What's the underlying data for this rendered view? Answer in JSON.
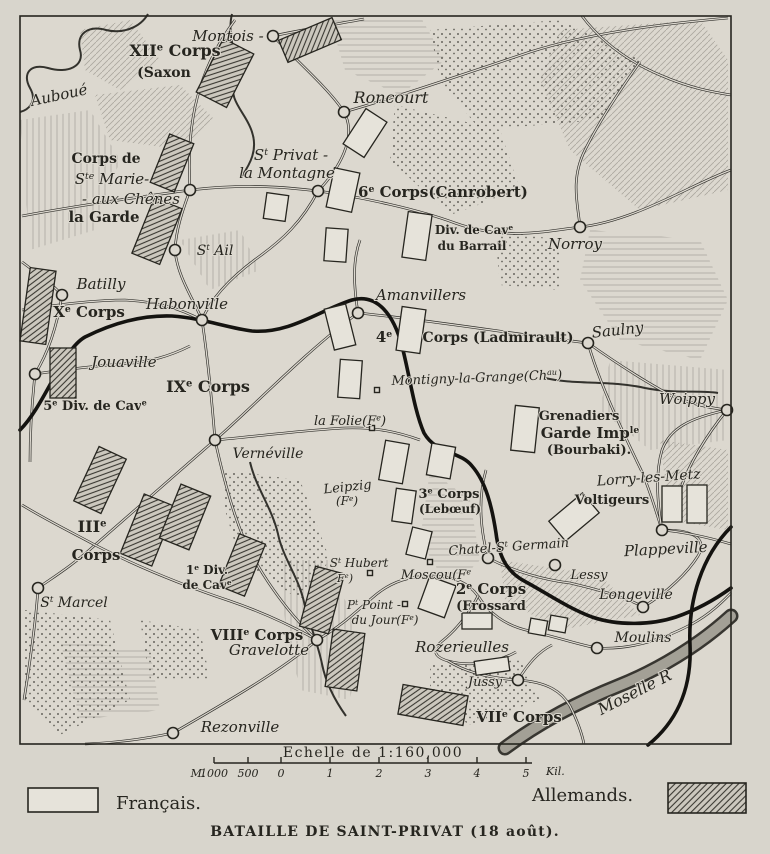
{
  "title": "Carte de la bataille de Saint-Privat",
  "colors": {
    "paper": "#d8d5cc",
    "map_fill": "#dcd8cf",
    "ink": "#26251f",
    "hatch_fill": "#ccc8be",
    "unit_french_fill": "#e6e3da"
  },
  "legend": {
    "francais": "Français.",
    "allemands": "Allemands."
  },
  "caption": "BATAILLE DE SAINT-PRIVAT (18 août).",
  "scale": {
    "title": "Echelle de 1:160,000",
    "unit_prefix": "M.",
    "unit_suffix": "Kil.",
    "bar": {
      "x1": 214,
      "x2": 526,
      "y": 763
    },
    "ticks": [
      {
        "x": 214,
        "label": "1000"
      },
      {
        "x": 248,
        "label": "500"
      },
      {
        "x": 281,
        "label": "0"
      },
      {
        "x": 330,
        "label": "1"
      },
      {
        "x": 379,
        "label": "2"
      },
      {
        "x": 428,
        "label": "3"
      },
      {
        "x": 477,
        "label": "4"
      },
      {
        "x": 526,
        "label": "5"
      }
    ]
  },
  "map": {
    "frame": {
      "x": 20,
      "y": 16,
      "w": 711,
      "h": 728
    },
    "labels": [
      {
        "id": "xii-corps",
        "t": "XII|e| Corps",
        "x": 175,
        "y": 56,
        "s": 16
      },
      {
        "id": "saxon",
        "t": "(Saxon",
        "x": 164,
        "y": 77,
        "s": 14
      },
      {
        "id": "montois",
        "t": "Montois -",
        "x": 228,
        "y": 41,
        "s": 15,
        "it": 1
      },
      {
        "id": "auboue",
        "t": "Auboué",
        "x": 60,
        "y": 100,
        "s": 15,
        "it": 1,
        "r": -12
      },
      {
        "id": "roncourt",
        "t": "Roncourt",
        "x": 391,
        "y": 103,
        "s": 16,
        "it": 1
      },
      {
        "id": "corps-de",
        "t": "Corps de",
        "x": 106,
        "y": 163,
        "s": 14
      },
      {
        "id": "ste-marie",
        "t": "S|te| Marie-",
        "x": 112,
        "y": 184,
        "s": 15,
        "it": 1
      },
      {
        "id": "aux-chenes",
        "t": "- aux Chênes",
        "x": 131,
        "y": 204,
        "s": 15,
        "it": 1
      },
      {
        "id": "la-garde",
        "t": "la Garde",
        "x": 104,
        "y": 222,
        "s": 15
      },
      {
        "id": "st-privat",
        "t": "S|t| Privat -",
        "x": 291,
        "y": 160,
        "s": 15,
        "it": 1
      },
      {
        "id": "la-montagne",
        "t": "la Montagne",
        "x": 287,
        "y": 178,
        "s": 15,
        "it": 1
      },
      {
        "id": "sixth-corps",
        "t": "6|e| Corps(Canrobert)",
        "x": 358,
        "y": 197,
        "s": 15,
        "a": "start"
      },
      {
        "id": "st-ail",
        "t": "S|t| Ail",
        "x": 215,
        "y": 255,
        "s": 14,
        "it": 1
      },
      {
        "id": "div-cav-barrail",
        "t": "Div. de Cav|e|",
        "x": 474,
        "y": 234,
        "s": 12
      },
      {
        "id": "du-barrail",
        "t": "du Barrail",
        "x": 472,
        "y": 250,
        "s": 12
      },
      {
        "id": "norroy",
        "t": "Norroy",
        "x": 575,
        "y": 249,
        "s": 15,
        "it": 1
      },
      {
        "id": "batilly",
        "t": "Batilly",
        "x": 101,
        "y": 289,
        "s": 15,
        "it": 1
      },
      {
        "id": "xe-corps",
        "t": "X|e| Corps",
        "x": 89,
        "y": 317,
        "s": 15
      },
      {
        "id": "habonville",
        "t": "Habonville",
        "x": 187,
        "y": 309,
        "s": 15,
        "it": 1
      },
      {
        "id": "jouaville",
        "t": "Jouaville",
        "x": 124,
        "y": 367,
        "s": 15,
        "it": 1
      },
      {
        "id": "amanvillers",
        "t": "Amanvillers",
        "x": 421,
        "y": 300,
        "s": 15,
        "it": 1
      },
      {
        "id": "fourth-corps-num",
        "t": "4|e|",
        "x": 384,
        "y": 342,
        "s": 15
      },
      {
        "id": "fourth-corps-name",
        "t": "Corps (Ladmirault)",
        "x": 498,
        "y": 342,
        "s": 14
      },
      {
        "id": "ixe-corps",
        "t": "IX|e| Corps",
        "x": 208,
        "y": 392,
        "s": 16
      },
      {
        "id": "fifth-div-cav",
        "t": "5|e| Div. de Cav|e|",
        "x": 95,
        "y": 410,
        "s": 13
      },
      {
        "id": "saulny",
        "t": "Saulny",
        "x": 618,
        "y": 335,
        "s": 15,
        "it": 1,
        "r": -6
      },
      {
        "id": "montigny",
        "t": "Montigny-la-Grange(Ch|au|)",
        "x": 477,
        "y": 382,
        "s": 13,
        "it": 1,
        "r": -2
      },
      {
        "id": "woippy",
        "t": "Woippy",
        "x": 687,
        "y": 404,
        "s": 15,
        "it": 1
      },
      {
        "id": "grenadiers",
        "t": "Grenadiers",
        "x": 579,
        "y": 420,
        "s": 13
      },
      {
        "id": "garde-imp",
        "t": "Garde Imp|le|",
        "x": 590,
        "y": 438,
        "s": 15
      },
      {
        "id": "bourbaki",
        "t": "(Bourbaki).",
        "x": 589,
        "y": 454,
        "s": 13
      },
      {
        "id": "la-folie",
        "t": "la Folie(F|e|)",
        "x": 350,
        "y": 425,
        "s": 13,
        "it": 1
      },
      {
        "id": "verneville",
        "t": "Vernéville",
        "x": 268,
        "y": 458,
        "s": 14,
        "it": 1
      },
      {
        "id": "leipzig",
        "t": "Leipzig",
        "x": 348,
        "y": 491,
        "s": 13,
        "it": 1,
        "r": -6
      },
      {
        "id": "leipzig-fe",
        "t": "(F|e|)",
        "x": 347,
        "y": 505,
        "s": 12,
        "it": 1
      },
      {
        "id": "lorry",
        "t": "Lorry-les-Metz",
        "x": 649,
        "y": 482,
        "s": 14,
        "it": 1,
        "r": -4
      },
      {
        "id": "voltigeurs",
        "t": "Voltigeurs",
        "x": 612,
        "y": 504,
        "s": 13
      },
      {
        "id": "third-corps",
        "t": "3|e| Corps",
        "x": 449,
        "y": 498,
        "s": 13
      },
      {
        "id": "leboeuf",
        "t": "(Lebœuf)",
        "x": 450,
        "y": 513,
        "s": 12
      },
      {
        "id": "iii-corps-num",
        "t": "III|e|",
        "x": 92,
        "y": 532,
        "s": 16
      },
      {
        "id": "iii-corps-name",
        "t": "Corps",
        "x": 96,
        "y": 560,
        "s": 15
      },
      {
        "id": "first-div",
        "t": "1|e| Div.",
        "x": 207,
        "y": 574,
        "s": 12
      },
      {
        "id": "first-div-cav",
        "t": "de Cav|e|",
        "x": 207,
        "y": 589,
        "s": 12
      },
      {
        "id": "chatel",
        "t": "Chatel-S|t| Germain",
        "x": 509,
        "y": 551,
        "s": 13,
        "it": 1,
        "r": -4
      },
      {
        "id": "plappeville",
        "t": "Plappeville",
        "x": 666,
        "y": 554,
        "s": 15,
        "it": 1,
        "r": -3
      },
      {
        "id": "lessy",
        "t": "Lessy",
        "x": 589,
        "y": 579,
        "s": 13,
        "it": 1
      },
      {
        "id": "longeville",
        "t": "Longeville",
        "x": 636,
        "y": 599,
        "s": 14,
        "it": 1
      },
      {
        "id": "st-marcel",
        "t": "S|t| Marcel",
        "x": 74,
        "y": 607,
        "s": 14,
        "it": 1
      },
      {
        "id": "st-hubert",
        "t": "S|t| Hubert",
        "x": 359,
        "y": 567,
        "s": 12,
        "it": 1
      },
      {
        "id": "st-hubert-fe",
        "t": "F|e|)",
        "x": 345,
        "y": 582,
        "s": 11,
        "it": 1
      },
      {
        "id": "moscou",
        "t": "Moscou(F|e|",
        "x": 436,
        "y": 579,
        "s": 13,
        "it": 1
      },
      {
        "id": "second-corps",
        "t": "2|e| Corps",
        "x": 491,
        "y": 594,
        "s": 15
      },
      {
        "id": "frossard",
        "t": "(Frossard",
        "x": 491,
        "y": 610,
        "s": 13
      },
      {
        "id": "pt-point",
        "t": "P|t| Point -",
        "x": 374,
        "y": 609,
        "s": 12,
        "it": 1
      },
      {
        "id": "du-jour",
        "t": "du Jour(F|e|)",
        "x": 385,
        "y": 624,
        "s": 12,
        "it": 1
      },
      {
        "id": "viiie-corps",
        "t": "VIII|e| Corps",
        "x": 257,
        "y": 640,
        "s": 15
      },
      {
        "id": "gravelotte",
        "t": "Gravelotte",
        "x": 269,
        "y": 655,
        "s": 15,
        "it": 1
      },
      {
        "id": "rozerieulles",
        "t": "Rozerieulles",
        "x": 462,
        "y": 652,
        "s": 15,
        "it": 1
      },
      {
        "id": "moulins",
        "t": "Moulins",
        "x": 643,
        "y": 642,
        "s": 14,
        "it": 1
      },
      {
        "id": "jussy",
        "t": "Jussy",
        "x": 485,
        "y": 686,
        "s": 13,
        "it": 1
      },
      {
        "id": "viie-corps",
        "t": "VII|e| Corps",
        "x": 519,
        "y": 722,
        "s": 15
      },
      {
        "id": "rezonville",
        "t": "Rezonville",
        "x": 240,
        "y": 732,
        "s": 15,
        "it": 1
      },
      {
        "id": "moselle-river",
        "t": "Moselle R",
        "x": 637,
        "y": 697,
        "s": 16,
        "it": 1,
        "r": -27
      }
    ],
    "units": {
      "french": [
        [
          365,
          133,
          25,
          42,
          33
        ],
        [
          276,
          207,
          22,
          26,
          8
        ],
        [
          343,
          190,
          26,
          40,
          12
        ],
        [
          336,
          245,
          22,
          33,
          4
        ],
        [
          417,
          236,
          24,
          46,
          8
        ],
        [
          340,
          327,
          22,
          42,
          -14
        ],
        [
          411,
          330,
          24,
          44,
          8
        ],
        [
          350,
          379,
          22,
          38,
          4
        ],
        [
          394,
          462,
          24,
          40,
          10
        ],
        [
          441,
          461,
          24,
          32,
          10
        ],
        [
          404,
          506,
          20,
          33,
          8
        ],
        [
          419,
          543,
          20,
          28,
          14
        ],
        [
          437,
          597,
          28,
          34,
          20
        ],
        [
          477,
          621,
          30,
          16,
          0
        ],
        [
          538,
          627,
          17,
          15,
          10
        ],
        [
          558,
          624,
          17,
          15,
          10
        ],
        [
          525,
          429,
          24,
          45,
          6
        ],
        [
          672,
          504,
          20,
          36,
          0
        ],
        [
          697,
          504,
          20,
          38,
          0
        ],
        [
          574,
          517,
          44,
          26,
          -40
        ],
        [
          492,
          666,
          34,
          14,
          -8
        ]
      ],
      "german": [
        [
          225,
          73,
          34,
          60,
          27
        ],
        [
          310,
          40,
          58,
          24,
          -23
        ],
        [
          172,
          163,
          26,
          52,
          22
        ],
        [
          157,
          231,
          30,
          60,
          22
        ],
        [
          38,
          306,
          26,
          74,
          8
        ],
        [
          63,
          373,
          26,
          50,
          0
        ],
        [
          100,
          480,
          30,
          60,
          25
        ],
        [
          148,
          530,
          34,
          64,
          22
        ],
        [
          185,
          517,
          32,
          58,
          22
        ],
        [
          242,
          565,
          28,
          56,
          22
        ],
        [
          322,
          600,
          30,
          62,
          15
        ],
        [
          345,
          660,
          32,
          58,
          8
        ],
        [
          433,
          705,
          66,
          30,
          10
        ]
      ]
    },
    "towns": [
      [
        273,
        36
      ],
      [
        344,
        112
      ],
      [
        318,
        191
      ],
      [
        190,
        190
      ],
      [
        175,
        250
      ],
      [
        580,
        227
      ],
      [
        62,
        295
      ],
      [
        202,
        320
      ],
      [
        358,
        313
      ],
      [
        588,
        343
      ],
      [
        727,
        410
      ],
      [
        215,
        440
      ],
      [
        35,
        374
      ],
      [
        38,
        588
      ],
      [
        317,
        640
      ],
      [
        173,
        733
      ],
      [
        488,
        558
      ],
      [
        555,
        565
      ],
      [
        643,
        607
      ],
      [
        597,
        648
      ],
      [
        662,
        530
      ],
      [
        518,
        680
      ]
    ],
    "buildings": [
      [
        372,
        428
      ],
      [
        370,
        573
      ],
      [
        430,
        562
      ],
      [
        405,
        604
      ],
      [
        377,
        390
      ]
    ],
    "roads": [
      "M22,216 C80,205 140,197 190,190 C250,183 292,188 318,191 C362,197 420,210 455,223 C505,241 548,231 580,227 C635,221 690,185 731,170",
      "M273,36 C298,62 330,90 344,112 C358,138 338,170 318,191",
      "M344,112 C400,96 470,72 530,52 C590,33 660,24 728,18",
      "M273,36 C300,30 332,25 364,19",
      "M190,190 C182,212 176,230 175,250 C177,276 194,300 202,320",
      "M318,191 C302,222 282,240 260,256 C235,274 212,296 202,320",
      "M22,310 C55,305 95,300 125,300 C162,302 182,310 202,320",
      "M202,320 C208,360 212,402 215,440",
      "M215,440 C252,408 305,352 358,313",
      "M358,313 C430,320 520,335 588,343",
      "M588,343 C612,360 642,380 672,396 C692,404 710,408 727,410",
      "M588,343 C600,385 622,430 642,472 C652,496 656,512 662,530",
      "M358,313 C354,288 352,262 360,240",
      "M215,440 C172,478 130,514 95,545 C72,566 52,578 38,588",
      "M22,505 C50,522 75,534 95,545 C140,568 185,586 230,601 C262,612 292,626 317,640",
      "M38,588 C36,622 30,662 24,700",
      "M317,640 C282,670 230,700 173,733",
      "M173,733 C140,740 110,743 85,744",
      "M317,640 C340,627 356,612 372,598 C392,580 412,576 432,576 C452,576 468,582 478,596 C488,612 505,626 530,631 C560,638 580,645 597,648",
      "M597,648 C630,650 662,640 692,624 C712,613 724,600 731,593",
      "M478,596 C468,616 454,632 441,642 C432,650 434,657 448,661 C470,667 496,663 516,652",
      "M488,558 C515,572 545,580 570,583 C600,590 628,598 643,607",
      "M643,607 C668,592 688,572 698,556 C706,542 698,534 680,531 C672,530 668,530 662,530",
      "M662,530 C686,532 710,538 731,544",
      "M662,530 C657,502 655,474 662,450 C670,428 690,418 727,410",
      "M448,661 C462,670 485,678 518,680 C548,682 562,692 570,706 C578,722 582,734 584,744",
      "M518,680 C528,664 538,652 552,645",
      "M190,190 C188,156 190,120 200,88 C208,62 220,40 235,20",
      "M22,262 C38,274 52,284 62,295",
      "M62,295 C58,320 50,350 35,374",
      "M35,374 C62,370 92,366 122,364 C150,362 170,356 190,346",
      "M35,374 C32,402 30,432 30,462",
      "M215,440 C260,436 305,430 345,428 C375,427 398,432 420,440",
      "M215,440 C222,472 230,504 242,534 C256,568 286,612 317,640",
      "M488,558 C480,528 478,498 486,470",
      "M582,16 C600,40 625,60 660,75 C690,88 712,92 731,95",
      "M640,62 C620,90 600,120 585,150 C570,180 578,205 580,227",
      "M727,410 C706,436 690,462 680,490"
    ],
    "railway": [
      "M20,430 C45,405 62,350 85,337 C115,322 145,315 172,316 C202,318 228,328 252,331 C290,334 320,310 352,300 C378,293 394,316 402,346 C410,377 414,410 424,433 C436,454 460,451 472,466 C486,482 492,507 496,533 C499,558 508,573 526,582 C548,594 568,608 592,617 C618,626 652,625 676,617 C702,608 720,596 731,588",
      "M731,527 C702,556 688,600 690,645 C692,692 674,724 648,745"
    ],
    "rivers": [
      "M148,14 C140,28 122,34 106,30 C88,25 76,34 80,50 C85,66 68,74 48,68 C30,63 22,74 30,88 C38,102 28,110 20,112",
      "M232,14 C226,38 240,58 234,80 C228,102 246,112 252,132 C258,150 250,164 242,176",
      "M250,462 C256,488 272,508 278,534 C283,558 298,576 304,602 C310,626 318,644 322,664 C326,684 336,702 346,716",
      "M545,378 C575,385 610,380 645,388 C675,394 700,390 718,393"
    ],
    "moselle": "M505,748 C540,722 578,702 618,686 C658,670 698,646 731,616",
    "terrain": {
      "hills": [
        "560,30 700,20 728,60 728,190 640,210 570,150 540,80",
        "330,20 420,16 445,60 400,95 345,70",
        "20,120 90,110 120,160 95,230 30,250",
        "80,30 130,20 160,60 120,90 85,70",
        "590,230 700,240 728,300 700,360 620,340 580,280",
        "610,360 728,370 728,440 650,450 600,410",
        "660,440 728,450 728,530 670,520",
        "430,470 470,500 480,560 450,590 420,540",
        "280,560 330,560 360,640 350,700 300,690 285,620",
        "500,560 600,575 640,615 560,630 505,600",
        "60,640 150,650 160,710 80,720",
        "180,240 240,230 260,270 210,290",
        "95,95 180,85 215,120 185,150 110,140"
      ],
      "woods": [
        "430,30 560,20 640,60 600,120 480,130 440,80",
        "395,105 500,130 520,190 450,215 390,160",
        "495,230 560,240 560,290 500,285",
        "225,470 300,480 330,560 300,600 240,560 225,510",
        "25,610 110,620 130,700 60,735 25,700",
        "430,665 520,660 540,700 470,725 430,700",
        "140,620 200,630 210,680 150,680"
      ]
    }
  }
}
